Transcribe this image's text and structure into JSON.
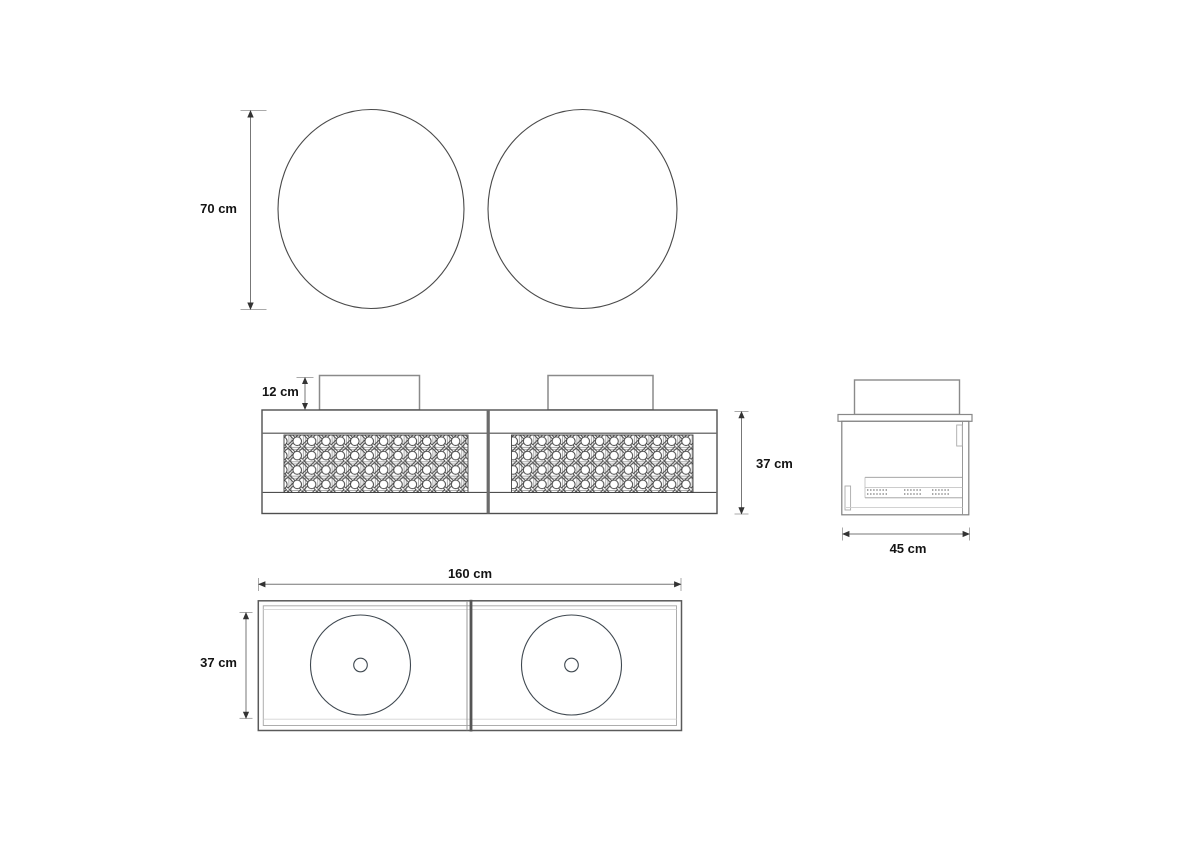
{
  "dimensions": {
    "mirror_diameter": "70 cm",
    "basin_height": "12 cm",
    "cabinet_height": "37 cm",
    "side_depth": "45 cm",
    "total_width": "160 cm",
    "plan_inner_depth": "37 cm"
  },
  "views": {
    "mirror_count": 2,
    "basin_count": 2,
    "cane_panel_count": 2
  },
  "colors": {
    "main_line": "#4a4a4a",
    "light_line": "#9a9a9a",
    "faint_line": "#cccccc",
    "dim_line": "#777777",
    "arrow": "#333333",
    "text": "#141414",
    "background": "#ffffff"
  }
}
